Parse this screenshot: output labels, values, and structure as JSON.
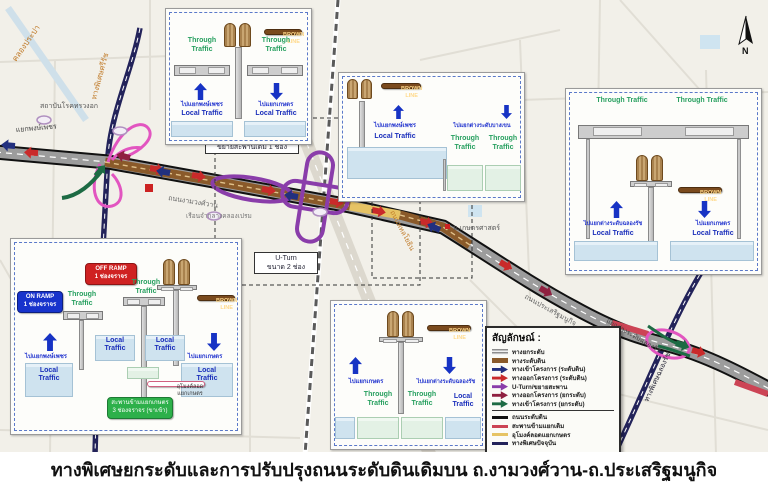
{
  "title": "ทางพิเศษยกระดับและการปรับปรุงถนนระดับดินเดิมบน ถ.งามวงศ์วาน-ถ.ประเสริฐมนูกิจ",
  "colors": {
    "elevated_gray": "#9a9a9a",
    "ground_brown": "#8a5a2a",
    "tunnel_yellow": "#e6c364",
    "existing_expressway_navy": "#23235a",
    "exit_red": "#c92a2a",
    "entrance_navy": "#22307f",
    "uturn_purple": "#8a3daa",
    "elevated_exit_maroon": "#8f2040",
    "elevated_entrance_green": "#1d6b44",
    "flyover_red": "#cc4455",
    "road_black": "#111111"
  },
  "legend": {
    "header": "สัญลักษณ์ :",
    "items": [
      {
        "label": "ทางยกระดับ",
        "style": "stripes",
        "color": "#9a9a9a"
      },
      {
        "label": "ทางระดับดิน",
        "style": "bar",
        "color": "#8a5a2a"
      },
      {
        "label": "ทางเข้าโครงการ (ระดับดิน)",
        "style": "arrow",
        "color": "#22307f"
      },
      {
        "label": "ทางออกโครงการ (ระดับดิน)",
        "style": "arrow",
        "color": "#c92a2a"
      },
      {
        "label": "U-Turn/ขยายสะพาน",
        "style": "arrow",
        "color": "#8a3daa"
      },
      {
        "label": "ทางออกโครงการ (ยกระดับ)",
        "style": "arrow",
        "color": "#8f2040"
      },
      {
        "label": "ทางเข้าโครงการ (ยกระดับ)",
        "style": "arrow",
        "color": "#1d6b44"
      },
      {
        "label": "ถนนระดับดิน",
        "style": "line",
        "color": "#111111"
      },
      {
        "label": "สะพานข้ามแยกเดิม",
        "style": "line",
        "color": "#cc4455"
      },
      {
        "label": "อุโมงค์ลอดแยกเกษตร",
        "style": "line",
        "color": "#e6c364"
      },
      {
        "label": "ทางพิเศษปัจจุบัน",
        "style": "line",
        "color": "#23235a"
      }
    ]
  },
  "map": {
    "boxes": {
      "expand_bridge": "ขยายสะพานเดิม 1 ช่อง",
      "uturn_line1": "U-Turn",
      "uturn_line2": "ขนาด 2 ช่อง"
    },
    "labels": {
      "klong_prapa": "คลองประปา",
      "sirat": "ทางพิเศษศรีรัช",
      "chest_institute": "สถาบันโรคทรวงอก",
      "phongphet": "แยกพงษ์เพชร",
      "prison": "เรือนจำกลางคลองเปรม",
      "ngamwongwan": "ถนนงามวงศ์วาน",
      "kasetsart": "ม.เกษตรศาสตร์",
      "phahonyothin": "ถนนพหลโยธิน",
      "prasert": "ถนนประเสริฐมนูกิจ",
      "chalongrat_ic": "แยกต่างระดับฉลองรัช",
      "chalongrat_expwy": "ทางพิเศษฉลองรัช",
      "north": "N"
    }
  },
  "insets": {
    "common": {
      "through": "Through Traffic",
      "local": "Local Traffic",
      "brown_line": "BROWN LINE"
    },
    "a": {
      "left_dir": "ไปแยกพงษ์เพชร",
      "right_dir": "ไปแยกเกษตร"
    },
    "b": {
      "left_dir": "ไปแยกพงษ์เพชร",
      "right_dir": "ไปแยกต่างระดับบางเขน"
    },
    "c": {
      "left_dir": "ไปแยกต่างระดับฉลองรัช",
      "right_dir": "ไปแยกเกษตร"
    },
    "d": {
      "on_ramp_line1": "ON RAMP",
      "on_ramp_line2": "1 ช่องจราจร",
      "off_ramp_line1": "OFF RAMP",
      "off_ramp_line2": "1 ช่องจราจร",
      "left_dir": "ไปแยกพงษ์เพชร",
      "right_dir": "ไปแยกเกษตร",
      "tunnel_callout": "อุโมงค์ลอดแยกเกษตร",
      "bridge_callout_line1": "สะพานข้ามแยกเกษตร",
      "bridge_callout_line2": "3 ช่องจราจร (ขาเข้า)"
    },
    "e": {
      "left_dir": "ไปแยกเกษตร",
      "right_dir": "ไปแยกต่างระดับฉลองรัช"
    }
  }
}
